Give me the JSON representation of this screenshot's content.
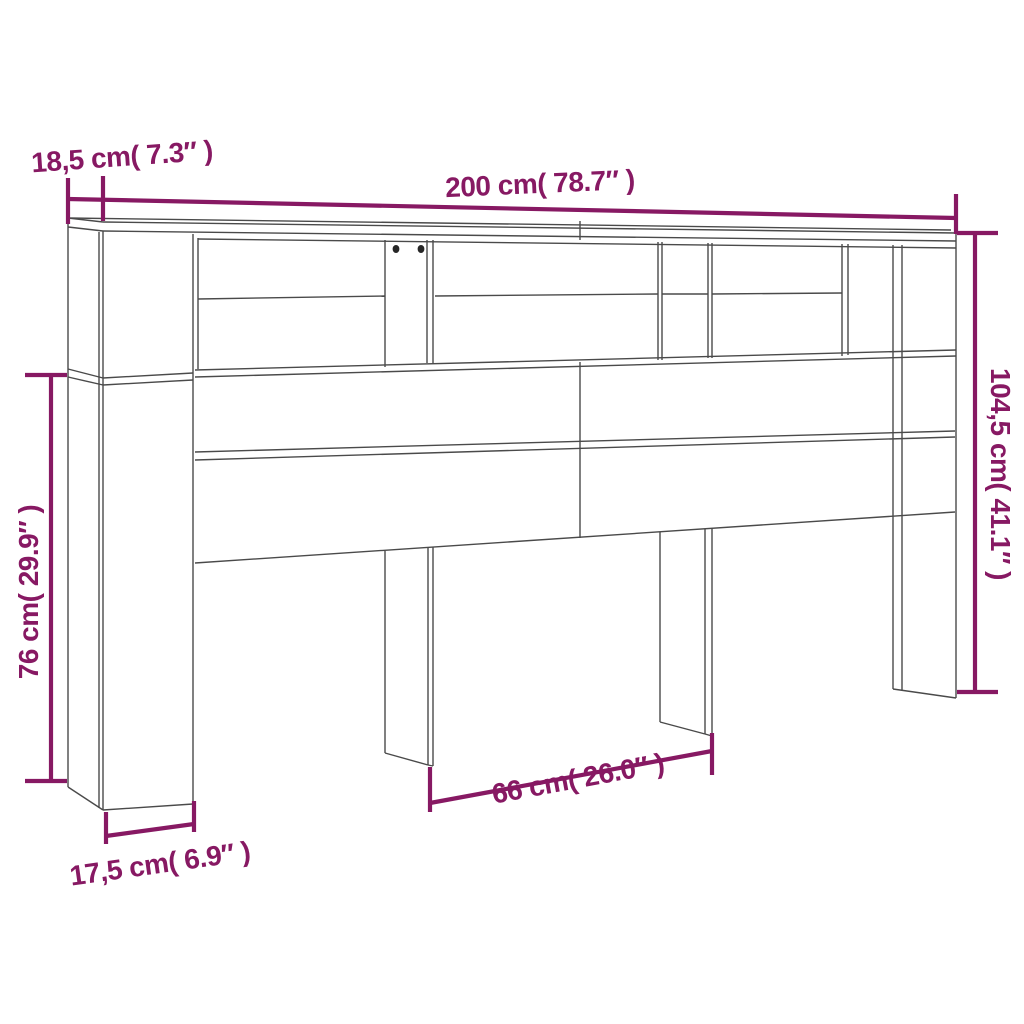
{
  "page": {
    "background": "#ffffff"
  },
  "diagram": {
    "type": "furniture-dimension-diagram",
    "subject": "headboard-cabinet-line-drawing",
    "accent_color": "#871963",
    "line_color": "#4a4a4a",
    "dimensions": {
      "width": {
        "value_cm": "200",
        "value_inch": "78.7",
        "text": "200 cm( 78.7″ )"
      },
      "top_depth": {
        "value_cm": "18,5",
        "value_inch": "7.3",
        "text": "18,5 cm( 7.3″ )"
      },
      "total_height": {
        "value_cm": "104,5",
        "value_inch": "41.1",
        "text": "104,5 cm( 41.1″ )"
      },
      "clearance_height": {
        "value_cm": "76",
        "value_inch": "29.9",
        "text": "76 cm( 29.9″ )"
      },
      "leg_spacing": {
        "value_cm": "66",
        "value_inch": "26.0",
        "text": "66 cm( 26.0″ )"
      },
      "base_depth": {
        "value_cm": "17,5",
        "value_inch": "6.9",
        "text": "17,5 cm( 6.9″ )"
      }
    }
  }
}
